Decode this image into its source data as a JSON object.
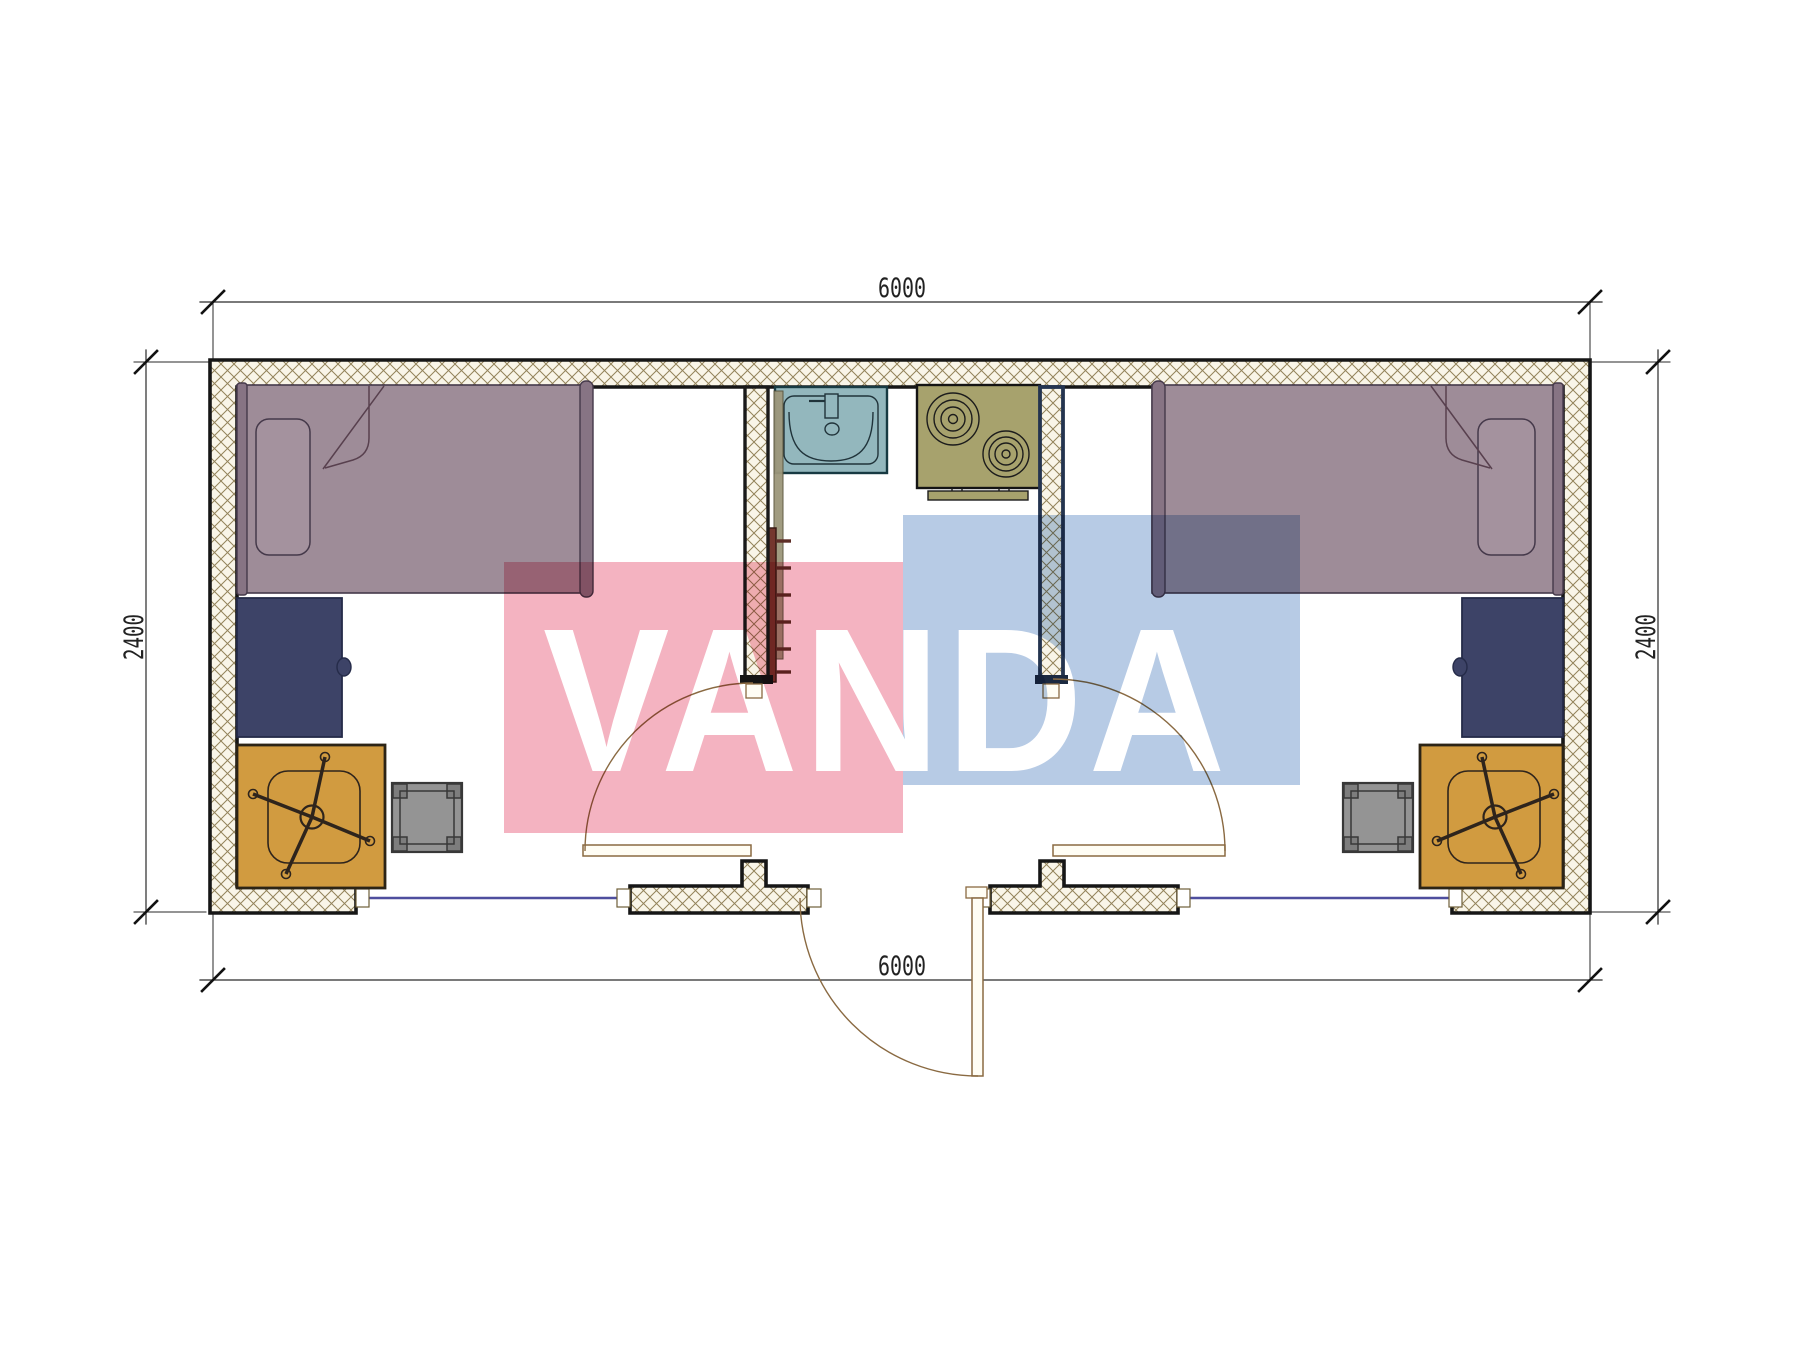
{
  "watermark": {
    "text": "VANDA",
    "text_color": "#ffffff",
    "pink_block": "#f4b3c1",
    "blue_block": "#b7cbe5"
  },
  "dimensions": {
    "top": "6000",
    "bottom": "6000",
    "left": "2400",
    "right": "2400"
  },
  "colors": {
    "wall_hatch_bg": "#f9f5e8",
    "wall_hatch_line": "#93835a",
    "wall_outline": "#161616",
    "interior_wall_outline": "#24344f",
    "bed": "#9e8c98",
    "bed_trim": "#877484",
    "pillow": "#a4929e",
    "desk": "#3d4367",
    "chair_mat": "#d19b40",
    "stool": "#949494",
    "stool_feet": "#7d7d7d",
    "sink": "#93b7bd",
    "stove": "#a7a26d",
    "ladder": "#74372e",
    "window": "#4e4e9e",
    "door": "#8a6a42",
    "door_leaf_fill": "#fffdf4",
    "dimension_line": "#2a2a2a",
    "dimension_text": "#222222"
  }
}
